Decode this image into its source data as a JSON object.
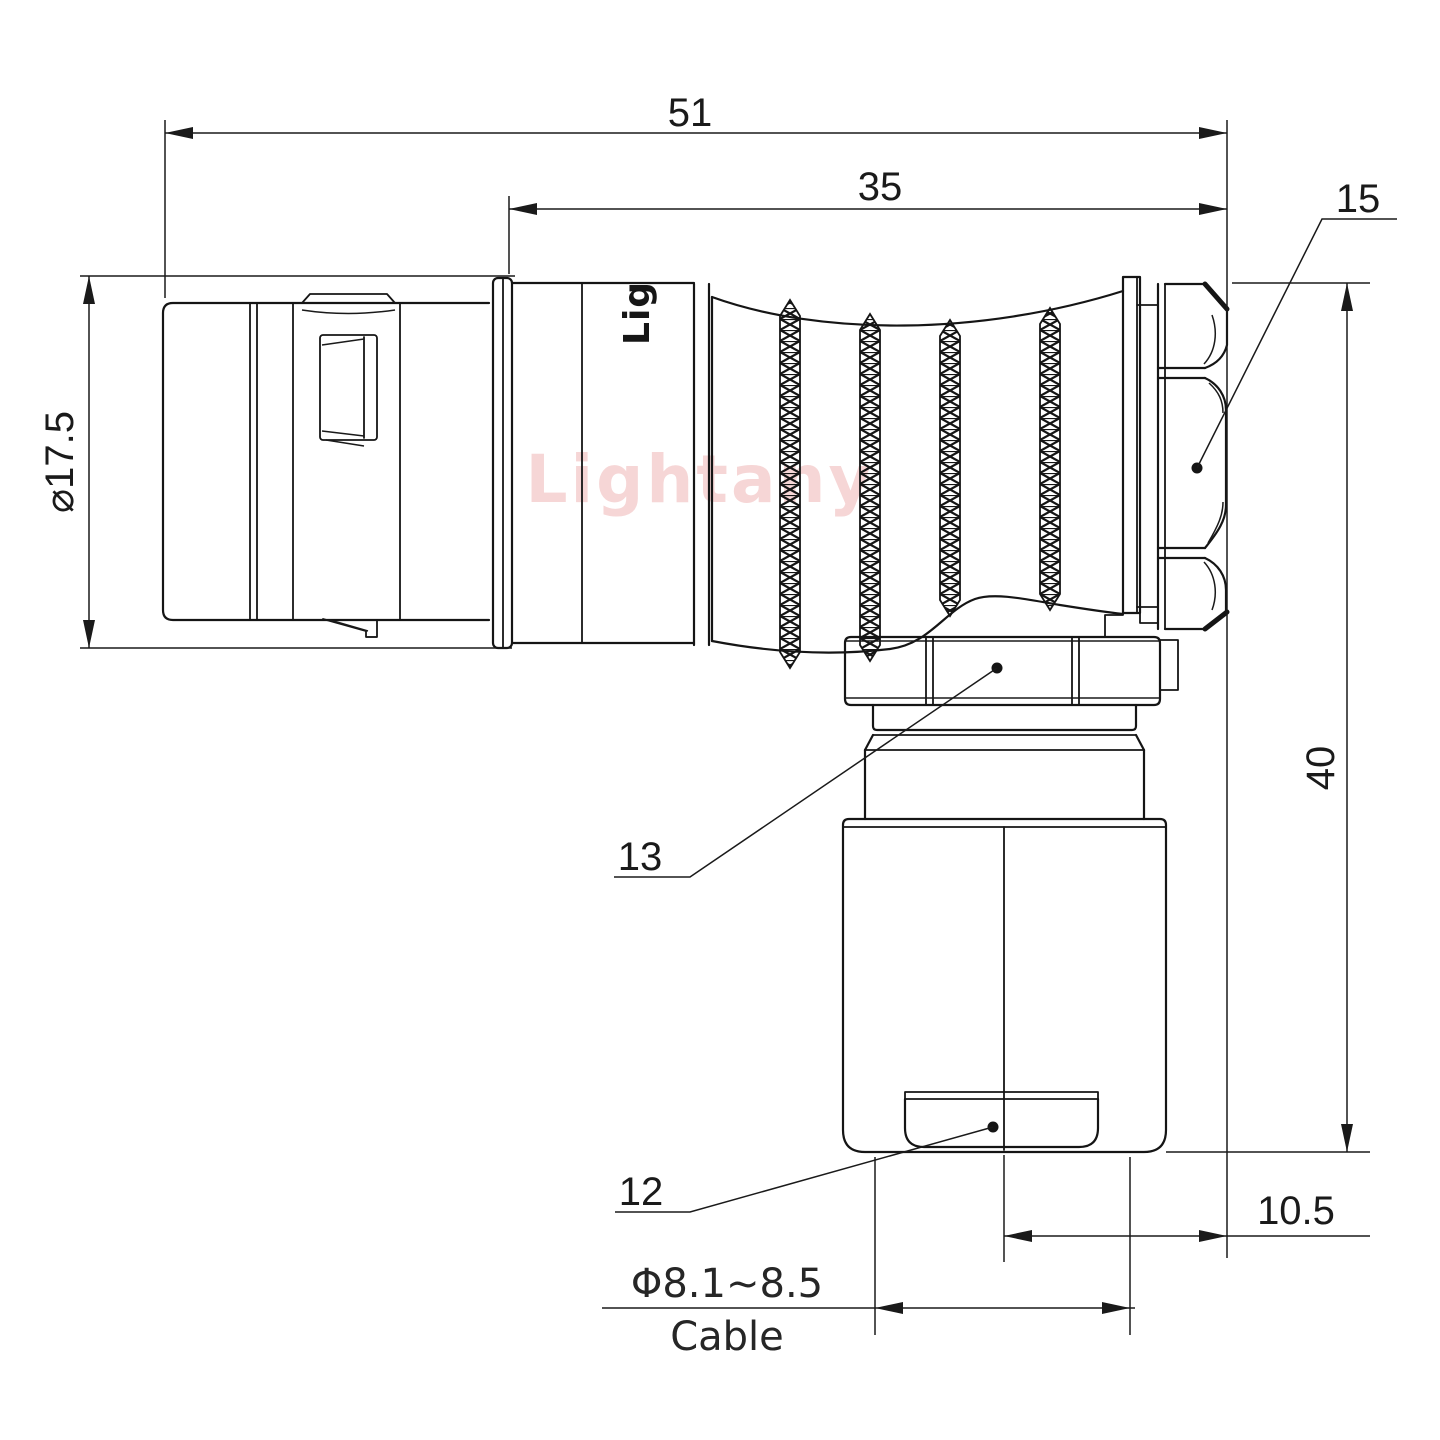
{
  "drawing": {
    "kind": "connector-technical-drawing",
    "background": "#ffffff",
    "line_color": "#151515",
    "watermark": {
      "text": "Lightany",
      "color": "#f6d6d6"
    },
    "engraving": {
      "text": "Lig"
    },
    "dimensions": {
      "overall_length": {
        "label": "51"
      },
      "grip_length": {
        "label": "35"
      },
      "shell_diameter": {
        "label": "⌀17.5"
      },
      "overall_height": {
        "label": "40"
      },
      "axis_offset": {
        "label": "10.5"
      },
      "cable_diameter": {
        "label": "Φ8.1~8.5"
      },
      "cable_word": {
        "label": "Cable"
      }
    },
    "callouts": {
      "backshell_nut": {
        "label": "15"
      },
      "coupling_nut": {
        "label": "13"
      },
      "cable_bushing": {
        "label": "12"
      }
    }
  }
}
